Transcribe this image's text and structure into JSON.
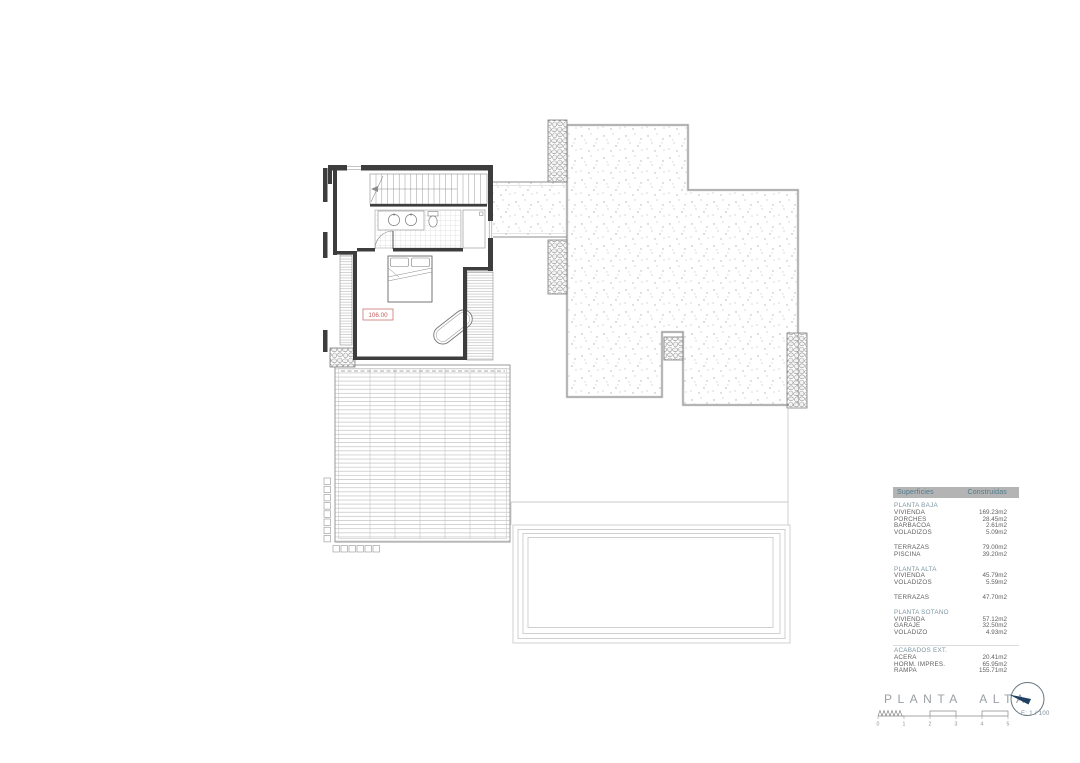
{
  "plan": {
    "elevation_label": "106.00"
  },
  "surfaces_table": {
    "header": {
      "col1": "Superficies",
      "col2": "Construidas"
    },
    "sections": [
      {
        "heading": "PLANTA BAJA",
        "rows": [
          {
            "label": "VIVIENDA",
            "value": "169.23m2"
          },
          {
            "label": "PORCHES",
            "value": "28.45m2"
          },
          {
            "label": "BARBACOA",
            "value": "2.61m2"
          },
          {
            "label": "VOLADIZOS",
            "value": "5.09m2"
          }
        ]
      },
      {
        "rows": [
          {
            "label": "TERRAZAS",
            "value": "79.00m2"
          },
          {
            "label": "PISCINA",
            "value": "39.20m2"
          }
        ]
      },
      {
        "heading": "PLANTA ALTA",
        "rows": [
          {
            "label": "VIVIENDA",
            "value": "45.79m2"
          },
          {
            "label": "VOLADIZOS",
            "value": "5.59m2"
          }
        ]
      },
      {
        "rows": [
          {
            "label": "TERRAZAS",
            "value": "47.70m2"
          }
        ]
      },
      {
        "heading": "PLANTA SOTANO",
        "rows": [
          {
            "label": "VIVIENDA",
            "value": "57.12m2"
          },
          {
            "label": "GARAJE",
            "value": "32.50m2"
          },
          {
            "label": "VOLADIZO",
            "value": "4.93m2"
          }
        ]
      },
      {
        "heading": "ACABADOS EXT.",
        "rows": [
          {
            "label": "ACERA",
            "value": "20.41m2"
          },
          {
            "label": "HORM. IMPRES.",
            "value": "65.95m2"
          },
          {
            "label": "RAMPA",
            "value": "155.71m2"
          }
        ]
      }
    ]
  },
  "title_block": {
    "title": "PLANTA ALTA",
    "scale_text": "E: 1 / 100",
    "scale_labels": [
      "0",
      "1",
      "2",
      "3",
      "4",
      "5"
    ]
  },
  "icons": {
    "north_arrow": "north-arrow-icon"
  },
  "colors": {
    "table_header_bg": "#b4b4b4",
    "table_header_text": "#4d7b8d",
    "section_heading": "#7b96a2",
    "elevation_red": "#c0625e",
    "compass_navy": "#1f3f63",
    "title_gray": "#9aa0a3"
  }
}
